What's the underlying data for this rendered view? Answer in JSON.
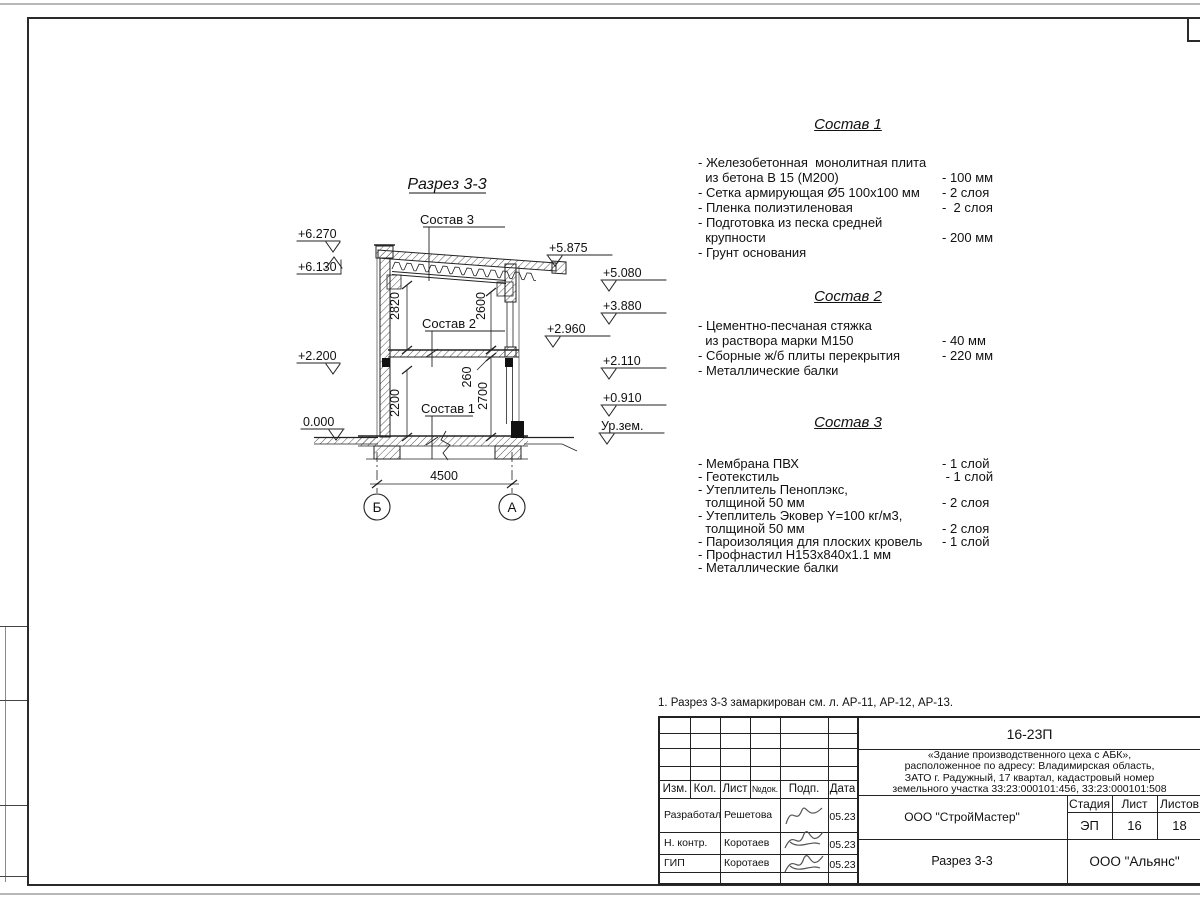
{
  "drawing": {
    "title": "Разрез 3-3",
    "section_labels": [
      "Состав 1",
      "Состав 2",
      "Состав 3"
    ],
    "dims": {
      "upper_left": "2820",
      "upper_right": "2600",
      "lower_left": "2200",
      "slab": "260",
      "lower_right": "2700",
      "span": "4500"
    },
    "axes": [
      "Б",
      "А"
    ],
    "elevations": [
      "+6.270",
      "+6.130",
      "+2.200",
      "0.000",
      "+5.875",
      "+2.960",
      "+5.080",
      "+3.880",
      "+2.110",
      "+0.910",
      "Ур.зем."
    ]
  },
  "compositions": [
    {
      "title": "Состав 1",
      "rows": [
        {
          "t": "- Железобетонная  монолитная плита",
          "v": ""
        },
        {
          "t": "  из бетона В 15 (М200)",
          "v": "- 100 мм"
        },
        {
          "t": "- Сетка армирующая Ø5 100х100 мм",
          "v": "- 2 слоя"
        },
        {
          "t": "- Пленка полиэтиленовая",
          "v": "-  2 слоя"
        },
        {
          "t": "- Подготовка из песка средней",
          "v": ""
        },
        {
          "t": "  крупности",
          "v": "- 200 мм"
        },
        {
          "t": "- Грунт основания",
          "v": ""
        }
      ]
    },
    {
      "title": "Состав 2",
      "rows": [
        {
          "t": "- Цементно-песчаная стяжка",
          "v": ""
        },
        {
          "t": "  из раствора марки М150",
          "v": "- 40 мм"
        },
        {
          "t": "- Сборные ж/б плиты перекрытия",
          "v": "- 220 мм"
        },
        {
          "t": "- Металлические балки",
          "v": ""
        }
      ]
    },
    {
      "title": "Состав 3",
      "rows": [
        {
          "t": "- Мембрана ПВХ",
          "v": "- 1 слой"
        },
        {
          "t": "- Геотекстиль",
          "v": " - 1 слой"
        },
        {
          "t": "- Утеплитель Пеноплэкс,",
          "v": ""
        },
        {
          "t": "  толщиной 50 мм",
          "v": "- 2 слоя"
        },
        {
          "t": "- Утеплитель Эковер Y=100 кг/м3,",
          "v": ""
        },
        {
          "t": "  толщиной 50 мм",
          "v": "- 2 слоя"
        },
        {
          "t": "- Пароизоляция для плоских кровель",
          "v": "- 1 слой"
        },
        {
          "t": "- Профнастил Н153х840х1.1 мм",
          "v": ""
        },
        {
          "t": "- Металлические балки",
          "v": ""
        }
      ]
    }
  ],
  "note": "1. Разрез 3-3 замаркирован см. л. АР-11, АР-12, АР-13.",
  "titleblock": {
    "doc_number": "16-23П",
    "project_desc_lines": [
      "«Здание производственного цеха с АБК»,",
      "расположенное по адресу: Владимирская область,",
      "ЗАТО г. Радужный, 17 квартал, кадастровый номер",
      "земельного участка 33:23:000101:456, 33:23:000101:508"
    ],
    "header_cells": [
      "Изм.",
      "Кол.",
      "Лист",
      "№док.",
      "Подп.",
      "Дата"
    ],
    "rows": [
      {
        "role": "Разработал",
        "name": "Решетова",
        "date": "05.23"
      },
      {
        "role": "Н. контр.",
        "name": "Коротаев",
        "date": "05.23"
      },
      {
        "role": "ГИП",
        "name": "Коротаев",
        "date": "05.23"
      }
    ],
    "org": "ООО \"СтройМастер\"",
    "stage_label": "Стадия",
    "sheet_label": "Лист",
    "sheets_label": "Листов",
    "stage": "ЭП",
    "sheet": "16",
    "sheets": "18",
    "sheet_title": "Разрез 3-3",
    "company": "ООО \"Альянс\""
  }
}
